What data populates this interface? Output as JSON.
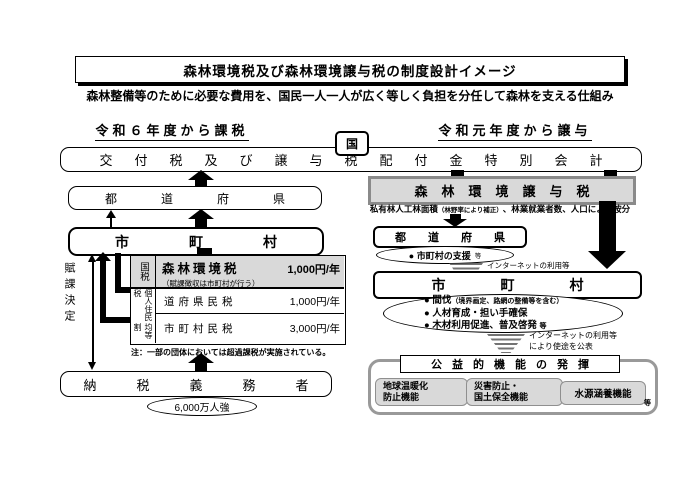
{
  "title": "森林環境税及び森林環境譲与税の制度設計イメージ",
  "subtitle": "森林整備等のために必要な費用を、国民一人一人が広く等しく負担を分任して森林を支える仕組み",
  "national": {
    "kuni_label": "国",
    "account_bar": "交付税及び譲与税配付金特別会計"
  },
  "left": {
    "heading": "令和６年度から課税",
    "prefecture_bar": "都道府県",
    "municipality_bar": "市町村",
    "assessment_label": "賦課決定",
    "tax_table": {
      "national_tax_label": "国税",
      "forest_tax_name": "森林環境税",
      "forest_tax_amount": "1,000円/年",
      "forest_tax_note": "（賦課徴収は市町村が行う）",
      "resident_tax_group": "個人住民税",
      "per_capita_label": "均等割",
      "rows": [
        {
          "name": "道府県民税",
          "amount": "1,000円/年"
        },
        {
          "name": "市町村民税",
          "amount": "3,000円/年"
        }
      ],
      "footnote": "注：一部の団体においては超過課税が実施されている。"
    },
    "taxpayer_bar": "納税義務者",
    "taxpayer_count": "6,000万人強"
  },
  "right": {
    "heading": "令和元年度から譲与",
    "transfer_tax_bar": "森林環境譲与税",
    "apportionment": {
      "part1": "私有林人工林面積",
      "note": "（林野率により補正）",
      "part2": "、林業就業者数、人口により按分"
    },
    "prefecture_bar": "都道府県",
    "prefecture_use": "● 市町村の支援",
    "prefecture_use_etc": "等",
    "disclosure_line1": "インターネットの利用等",
    "disclosure_line2": "により使途を公表",
    "municipality_bar": "市町村",
    "municipality_uses": [
      {
        "text": "● 間伐",
        "small": "（境界画定、路網の整備等を含む）"
      },
      {
        "text": "● 人材育成・担い手確保",
        "small": ""
      },
      {
        "text": "● 木材利用促進、普及啓発",
        "small": "等"
      }
    ],
    "benefits": {
      "heading": "公益的機能の発揮",
      "items": [
        {
          "line1": "地球温暖化",
          "line2": "防止機能"
        },
        {
          "line1": "災害防止・",
          "line2": "国土保全機能"
        },
        {
          "line1": "水源涵養機能",
          "line2": ""
        }
      ],
      "etc": "等"
    }
  },
  "colors": {
    "gray_fill": "#d9d9d9",
    "gray_border": "#8a8a8a",
    "black": "#000000"
  }
}
